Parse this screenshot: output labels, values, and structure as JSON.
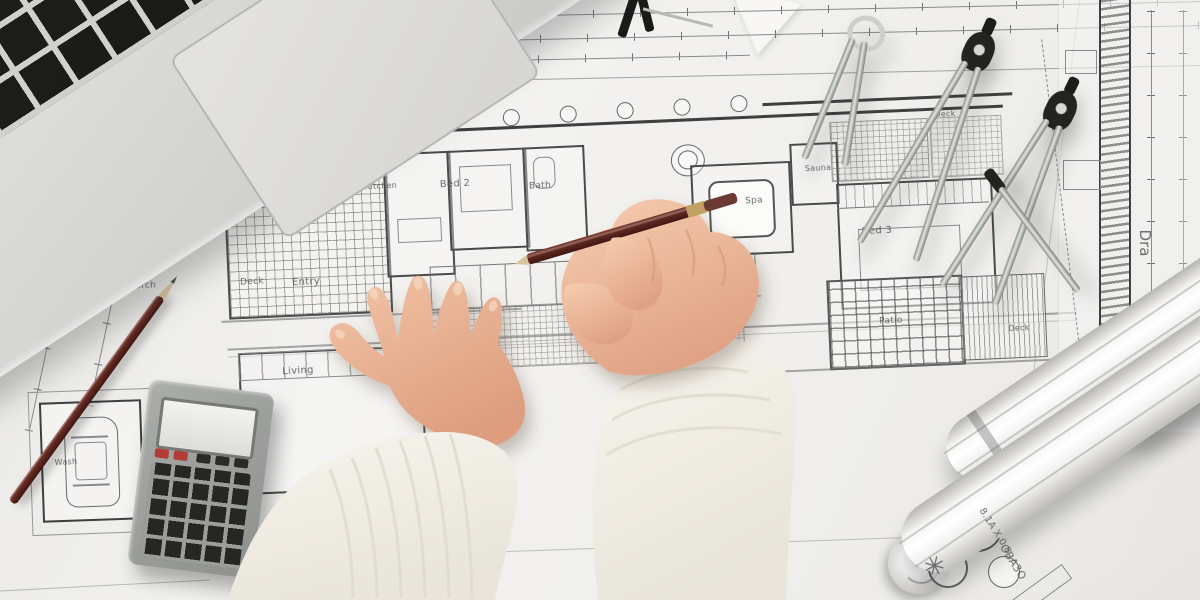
{
  "meta": {
    "type": "photograph",
    "description": "Top-down photo of an architect's hands drawing with a red pencil over house floor-plan blueprints; laptop corner top-left, pocket calculator and spare pencil at left, drafting compasses at right, rolled-up plans bottom-right."
  },
  "objects": [
    {
      "name": "laptop-keyboard-corner",
      "label": "silver laptop with black keys and trackpad"
    },
    {
      "name": "blueprint-floor-plan",
      "label": "house floor plan with hatched deck and patio areas"
    },
    {
      "name": "left-hand",
      "label": "left hand resting flat on blueprint"
    },
    {
      "name": "right-hand-with-pencil",
      "label": "right hand holding red drafting pencil"
    },
    {
      "name": "spare-pencil",
      "label": "sharpened red pencil lying on plans"
    },
    {
      "name": "calculator",
      "label": "grey pocket calculator with red keys"
    },
    {
      "name": "drafting-compasses",
      "label": "three metal compasses / dividers"
    },
    {
      "name": "rolled-blueprints",
      "label": "rolled-up blueprint sheets"
    },
    {
      "name": "garage-car-drawing",
      "label": "plan-view car drawn in garage bay"
    }
  ],
  "blueprint": {
    "labels": [
      {
        "text": "Porch",
        "x": 143,
        "y": 286,
        "r": -3,
        "s": 9
      },
      {
        "text": "Deck",
        "x": 252,
        "y": 282,
        "r": -3,
        "s": 9
      },
      {
        "text": "Entry",
        "x": 306,
        "y": 282,
        "r": -3,
        "s": 10
      },
      {
        "text": "Living",
        "x": 298,
        "y": 371,
        "r": -3,
        "s": 10
      },
      {
        "text": "Wash",
        "x": 66,
        "y": 462,
        "r": -3,
        "s": 8
      },
      {
        "text": "Kitchen",
        "x": 381,
        "y": 186,
        "r": -3,
        "s": 8
      },
      {
        "text": "Bed 2",
        "x": 455,
        "y": 184,
        "r": -3,
        "s": 10
      },
      {
        "text": "Bath",
        "x": 540,
        "y": 186,
        "r": -3,
        "s": 9
      },
      {
        "text": "Spa",
        "x": 754,
        "y": 201,
        "r": -3,
        "s": 9
      },
      {
        "text": "Sauna",
        "x": 818,
        "y": 168,
        "r": -3,
        "s": 8
      },
      {
        "text": "Bed 3",
        "x": 877,
        "y": 231,
        "r": -3,
        "s": 10
      },
      {
        "text": "Patio",
        "x": 891,
        "y": 321,
        "r": -3,
        "s": 9
      },
      {
        "text": "Deck",
        "x": 1019,
        "y": 328,
        "r": -3,
        "s": 8
      },
      {
        "text": "Deck",
        "x": 945,
        "y": 114,
        "r": -3,
        "s": 8
      }
    ],
    "annotations": [
      {
        "text": "8.1A X 0.8",
        "x": 995,
        "y": 531,
        "r": 58,
        "s": 10
      },
      {
        "text": "OBA3O",
        "x": 1013,
        "y": 562,
        "r": 58,
        "s": 11
      },
      {
        "text": "Dra",
        "x": 1145,
        "y": 243,
        "r": 90,
        "s": 15
      },
      {
        "text": "✳",
        "x": 934,
        "y": 567,
        "r": 15,
        "s": 26
      }
    ]
  },
  "palette": {
    "paper": "#f2f1ef",
    "plan_line_dark": "#3f3f3f",
    "plan_line_mid": "#777777",
    "laptop_silver": "#d6d6d4",
    "key_black": "#1c1c1a",
    "skin": "#eebd9e",
    "skin_shadow": "#d89a7a",
    "sweater_white": "#f3f0e9",
    "pencil_red": "#5c2522",
    "pencil_wood": "#dac49e",
    "metal": "#b9beb7",
    "metal_dark": "#23231f",
    "calc_body": "#9a9d9a",
    "calc_red_key": "#b33c34"
  }
}
